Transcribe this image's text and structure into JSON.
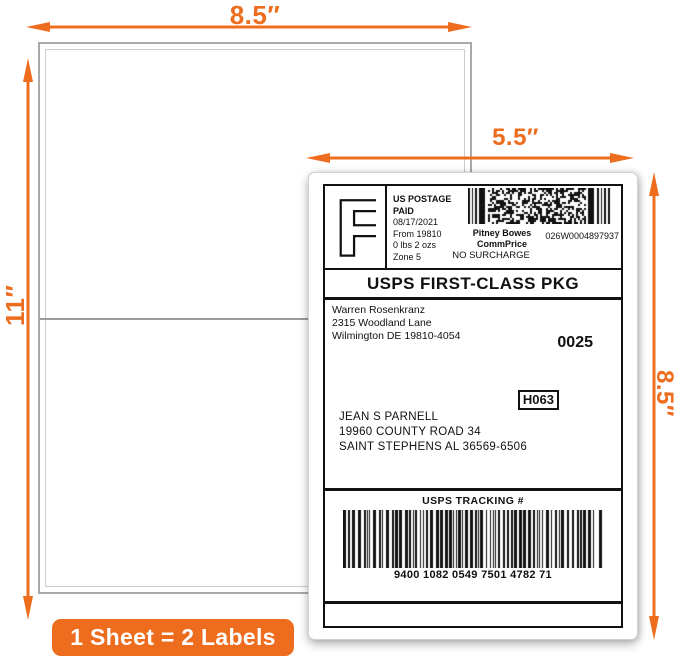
{
  "colors": {
    "accent_orange": "#ED6C1E",
    "label_black": "#111111"
  },
  "dims": {
    "sheet_width": "8.5″",
    "sheet_height": "11″",
    "label_width": "5.5″",
    "label_height": "8.5″"
  },
  "badge": {
    "text": "1 Sheet = 2 Labels"
  },
  "label": {
    "logo_letter": "F",
    "meter": {
      "line1": "US POSTAGE",
      "line2": "PAID",
      "date": "08/17/2021",
      "from": "From 19810",
      "weight": "0 lbs 2 ozs",
      "zone": "Zone 5",
      "carrier_line1": "Pitney Bowes",
      "carrier_line2": "CommPrice",
      "meter_number": "026W0004897937",
      "surcharge": "NO SURCHARGE"
    },
    "service": "USPS FIRST-CLASS PKG",
    "sender": {
      "name": "Warren Rosenkranz",
      "street": "2315 Woodland Lane",
      "city": "Wilmington DE 19810-4054"
    },
    "batch_number": "0025",
    "sort_code": "H063",
    "recipient": {
      "name": "JEAN S PARNELL",
      "street": "19960 COUNTY ROAD 34",
      "city": "SAINT STEPHENS AL 36569-6506"
    },
    "tracking": {
      "title": "USPS TRACKING #",
      "number": "9400 1082 0549 7501 4782 71"
    }
  }
}
